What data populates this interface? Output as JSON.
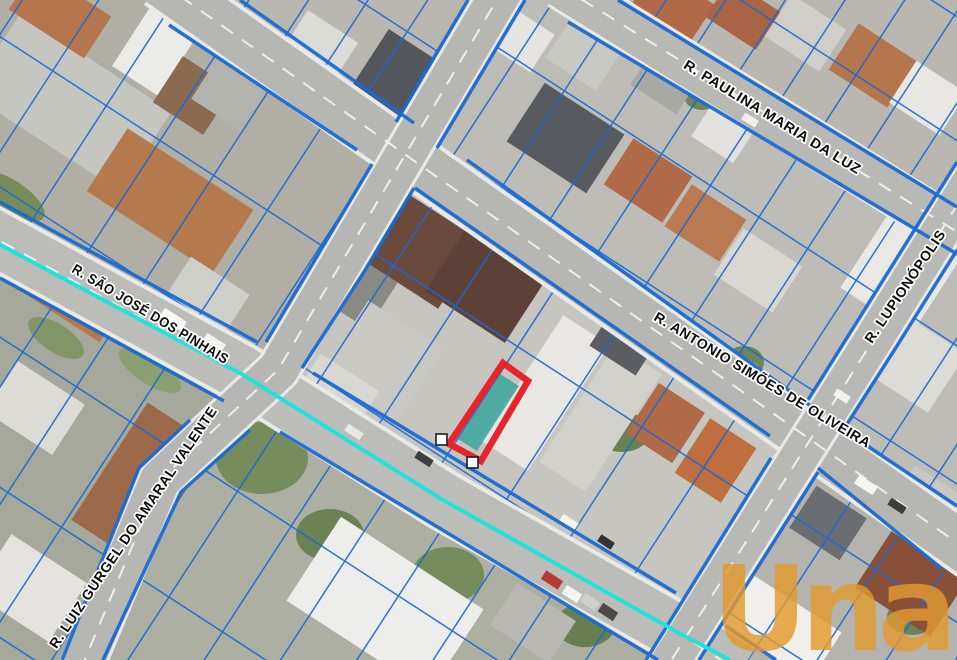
{
  "map_view": {
    "type": "aerial-cadastral-map",
    "streets": [
      {
        "name": "R. PAULINA MARIA DA LUZ"
      },
      {
        "name": "R. SÃO JOSÉ DOS PINHAIS"
      },
      {
        "name": "R. ANTONIO SIMÕES DE OLIVEIRA"
      },
      {
        "name": "R. LUPIONÓPOLIS"
      },
      {
        "name": "R. LUIZ GURGEL DO AMARAL VALENTE"
      }
    ],
    "watermark": {
      "text": "Una",
      "color": "#e29a2e"
    },
    "overlay_colors": {
      "parcel_lines": "#1a6ad4",
      "highlight_outline": "#e8232a",
      "highlight_fill": "#2ea39c",
      "route_line": "#22e3da",
      "vertex_marker_fill": "#ffffff",
      "vertex_marker_border": "#1c1c1c"
    },
    "highlight": {
      "vertex_markers": 2
    }
  }
}
